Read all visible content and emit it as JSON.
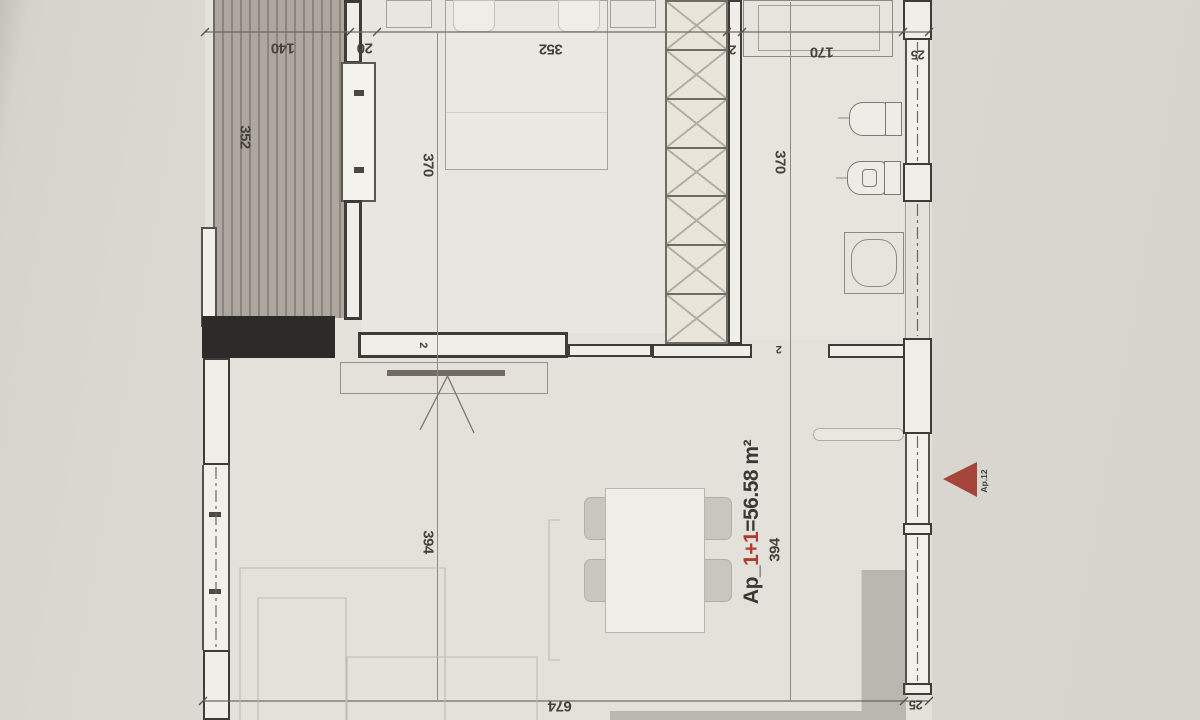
{
  "drawing": {
    "area_label": {
      "prefix": "Ap_",
      "rooms": "1+1",
      "equals_area": "=56.58 m²"
    },
    "apartment_marker": {
      "label": "Ap.12"
    },
    "dimensions": {
      "top_140": "140",
      "top_20": "20",
      "top_352": "352",
      "top_2": "2",
      "top_170": "170",
      "top_25": "25",
      "balcony_352": "352",
      "bedroom_370": "370",
      "bathroom_370": "370",
      "living_394_left": "394",
      "living_394_right": "394",
      "bottom_674": "674",
      "bottom_25": "25",
      "wall_2_left": "2",
      "wall_2_right": "2"
    },
    "colors": {
      "marker_red": "#a6453c",
      "label_red": "#b23a30",
      "ink": "#3e3c38",
      "paper": "#d9d6cf"
    }
  }
}
